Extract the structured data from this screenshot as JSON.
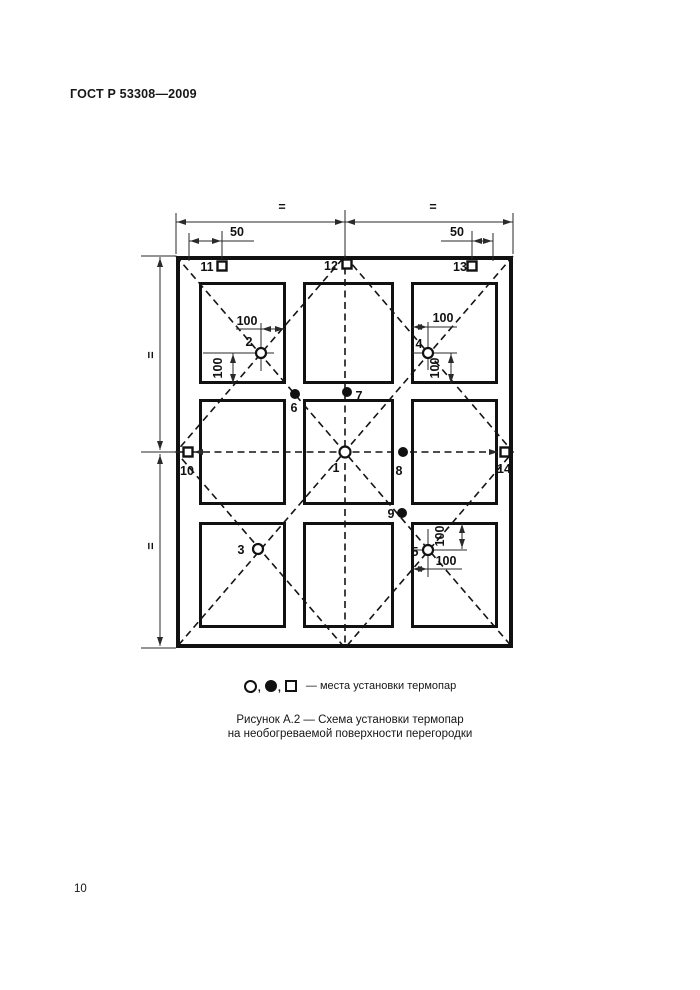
{
  "page": {
    "header": "ГОСТ Р 53308—2009",
    "page_number": "10"
  },
  "figure": {
    "caption_line1": "Рисунок А.2 — Схема установки термопар",
    "caption_line2": "на необогреваемой поверхности перегородки",
    "legend": {
      "comma": ",",
      "text": "— места установки термопар"
    },
    "dims": {
      "eq_top_left": "=",
      "eq_top_right": "=",
      "eq_left_upper": "=",
      "eq_left_lower": "=",
      "top_left_50": "50",
      "top_right_50": "50",
      "p2_h": "100",
      "p2_v": "100",
      "p4_h": "100",
      "p4_v": "100",
      "p5_h": "100",
      "p5_v": "100"
    },
    "points": {
      "p1": "1",
      "p2": "2",
      "p3": "3",
      "p4": "4",
      "p5": "5",
      "p6": "6",
      "p7": "7",
      "p8": "8",
      "p9": "9",
      "p10": "10",
      "p11": "11",
      "p12": "12",
      "p13": "13",
      "p14": "14"
    },
    "colors": {
      "ink": "#161616",
      "panel_top": "#fbfbfb",
      "panel_bottom": "#d4d4d4"
    }
  }
}
